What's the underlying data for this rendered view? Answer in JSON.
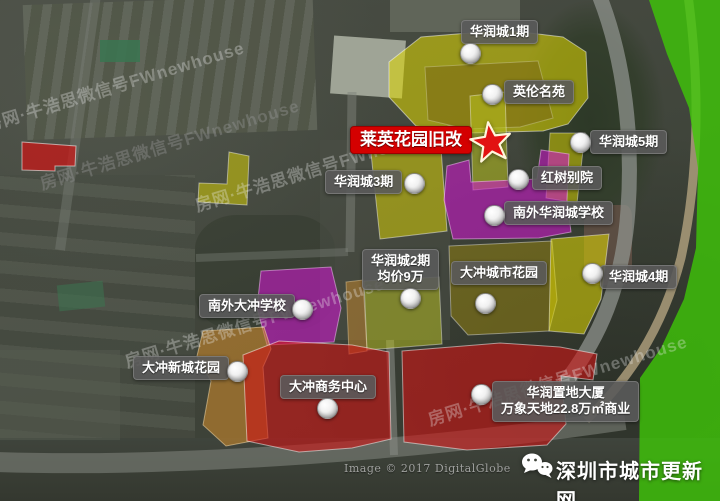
{
  "colors": {
    "yellow": "#e0d800",
    "yellow_green": "#b9c21f",
    "olive": "#8f7f12",
    "olive_dark": "#7d6c14",
    "magenta": "#cd17cd",
    "red_zone": "#cf1414",
    "green_zone": "#3ec708",
    "orange": "#c8872b",
    "label_bg": "rgba(90,90,90,0.9)",
    "highlight_bg": "#d40000",
    "star": "#e21212"
  },
  "watermark": {
    "text": "房网·牛浩思微信号FWnewhouse"
  },
  "copyright": "Image © 2017 DigitalGlobe",
  "brand": {
    "name": "深圳市城市更新网",
    "icon": "wechat-icon"
  },
  "highlight": {
    "text": "莱英花园旧改"
  },
  "labels": {
    "hrc1": {
      "text": "华润城1期"
    },
    "ylmy": {
      "text": "英伦名苑"
    },
    "hrc5": {
      "text": "华润城5期"
    },
    "hsby": {
      "text": "红树别院"
    },
    "hrc3": {
      "text": "华润城3期"
    },
    "nwhrc_school": {
      "text": "南外华润城学校"
    },
    "hrc2": {
      "line1": "华润城2期",
      "line2": "均价9万"
    },
    "dc_city_garden": {
      "text": "大冲城市花园"
    },
    "hrc4": {
      "text": "华润城4期"
    },
    "nwdc_school": {
      "text": "南外大冲学校"
    },
    "dc_xincheng": {
      "text": "大冲新城花园"
    },
    "dc_business": {
      "text": "大冲商务中心"
    },
    "hrzd": {
      "line1": "华润置地大厦",
      "line2": "万象天地22.8万㎡商业"
    }
  }
}
